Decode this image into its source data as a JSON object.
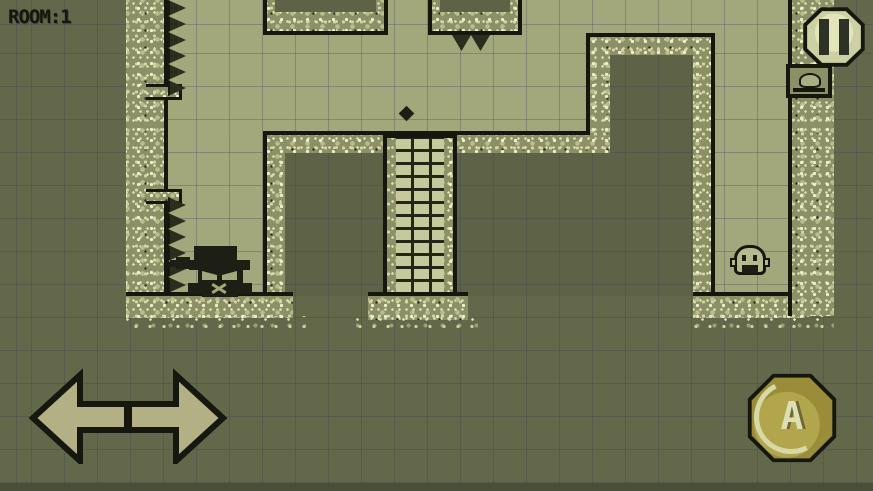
{
  "hud": {
    "room_label": "ROOM:1"
  },
  "controls": {
    "pause": {
      "icon": "pause-icon"
    },
    "action_button": {
      "label": "A"
    },
    "dpad": {
      "left_icon": "left-arrow-icon",
      "right_icon": "right-arrow-icon"
    }
  },
  "world": {
    "player": "masked-adventurer",
    "enemy": "slime",
    "wall_sign": "creature-sign",
    "hazards": {
      "left_wall_spikes": 12,
      "ceiling_spikes": 2
    },
    "structures": [
      "speckled-walls",
      "brick-pillar",
      "ceiling-platforms",
      "floor-ledges"
    ]
  },
  "colors": {
    "background": "#63684b",
    "play_area": "#a3a77c",
    "wall_texture": "#8b9066",
    "outline": "#16180f",
    "pause_button": "#d6d9ae",
    "action_button": "#a89b42",
    "arrow_buttons": "#b3b085"
  }
}
